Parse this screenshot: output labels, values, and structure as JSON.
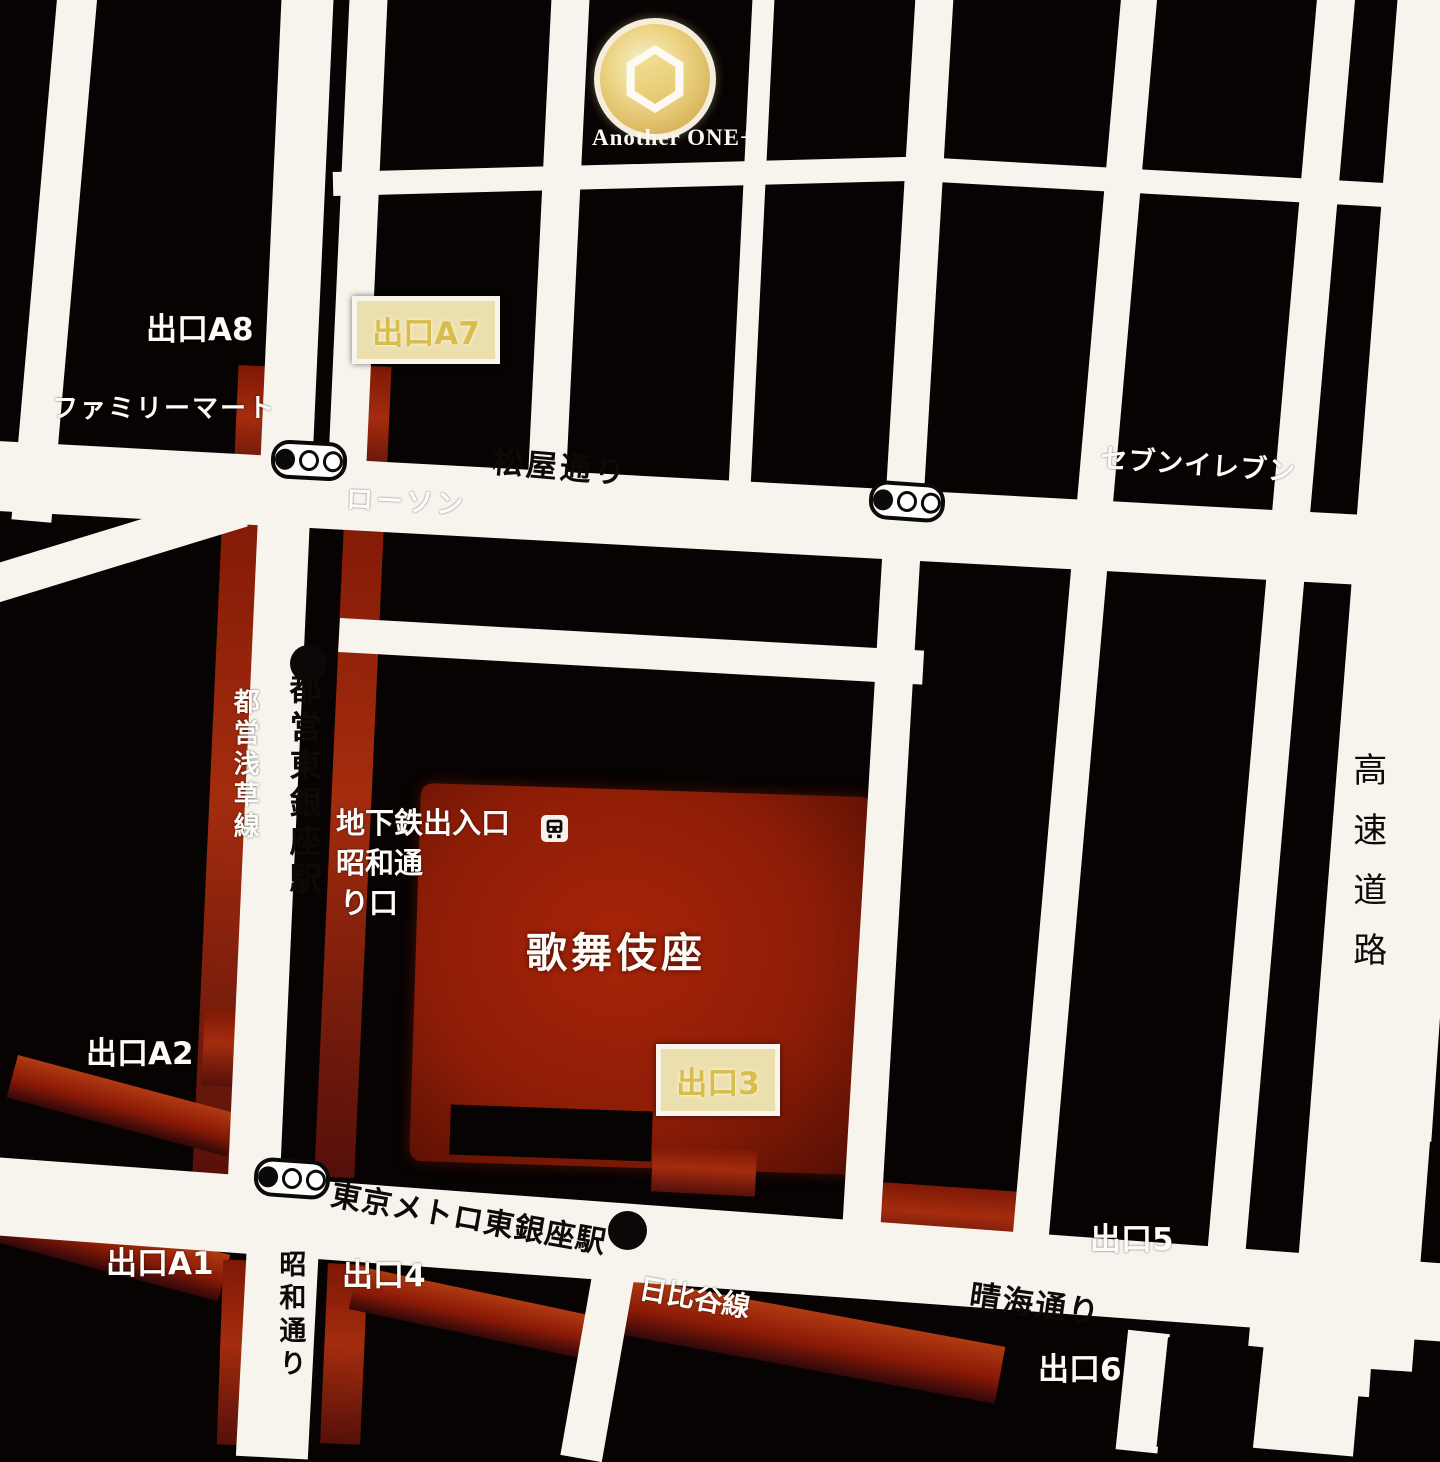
{
  "map": {
    "logo": {
      "name": "Another ONE+"
    },
    "streets": {
      "matsuya": "松屋通り",
      "harumi": "晴海通り",
      "showa": "昭和通り",
      "expressway": "高速道路"
    },
    "rail_lines": {
      "asakusa": "都営浅草線",
      "hibiya": "日比谷線"
    },
    "stations": {
      "toei_higashiginza": "都営東銀座駅",
      "metro_higashiginza": "東京メトロ東銀座駅"
    },
    "places": {
      "kabukiza": "歌舞伎座",
      "familymart": "ファミリーマート",
      "seveneleven": "セブンイレブン",
      "lawson": "ローソン"
    },
    "subway_entrance": {
      "line1": "地下鉄出入口",
      "line2": "昭和通",
      "line3": "り口"
    },
    "exits": {
      "a8": "出口A8",
      "a7": "出口A7",
      "a2": "出口A2",
      "a1": "出口A1",
      "n3": "出口3",
      "n4": "出口4",
      "n5": "出口5",
      "n6": "出口6"
    },
    "colors": {
      "background": "#070303",
      "road": "#f7f4ee",
      "red_accent": "#9b1e0a",
      "highlight_box": "#ecdfae",
      "highlight_text": "#d7bd4d",
      "logo_gold": "#e3c566"
    }
  }
}
